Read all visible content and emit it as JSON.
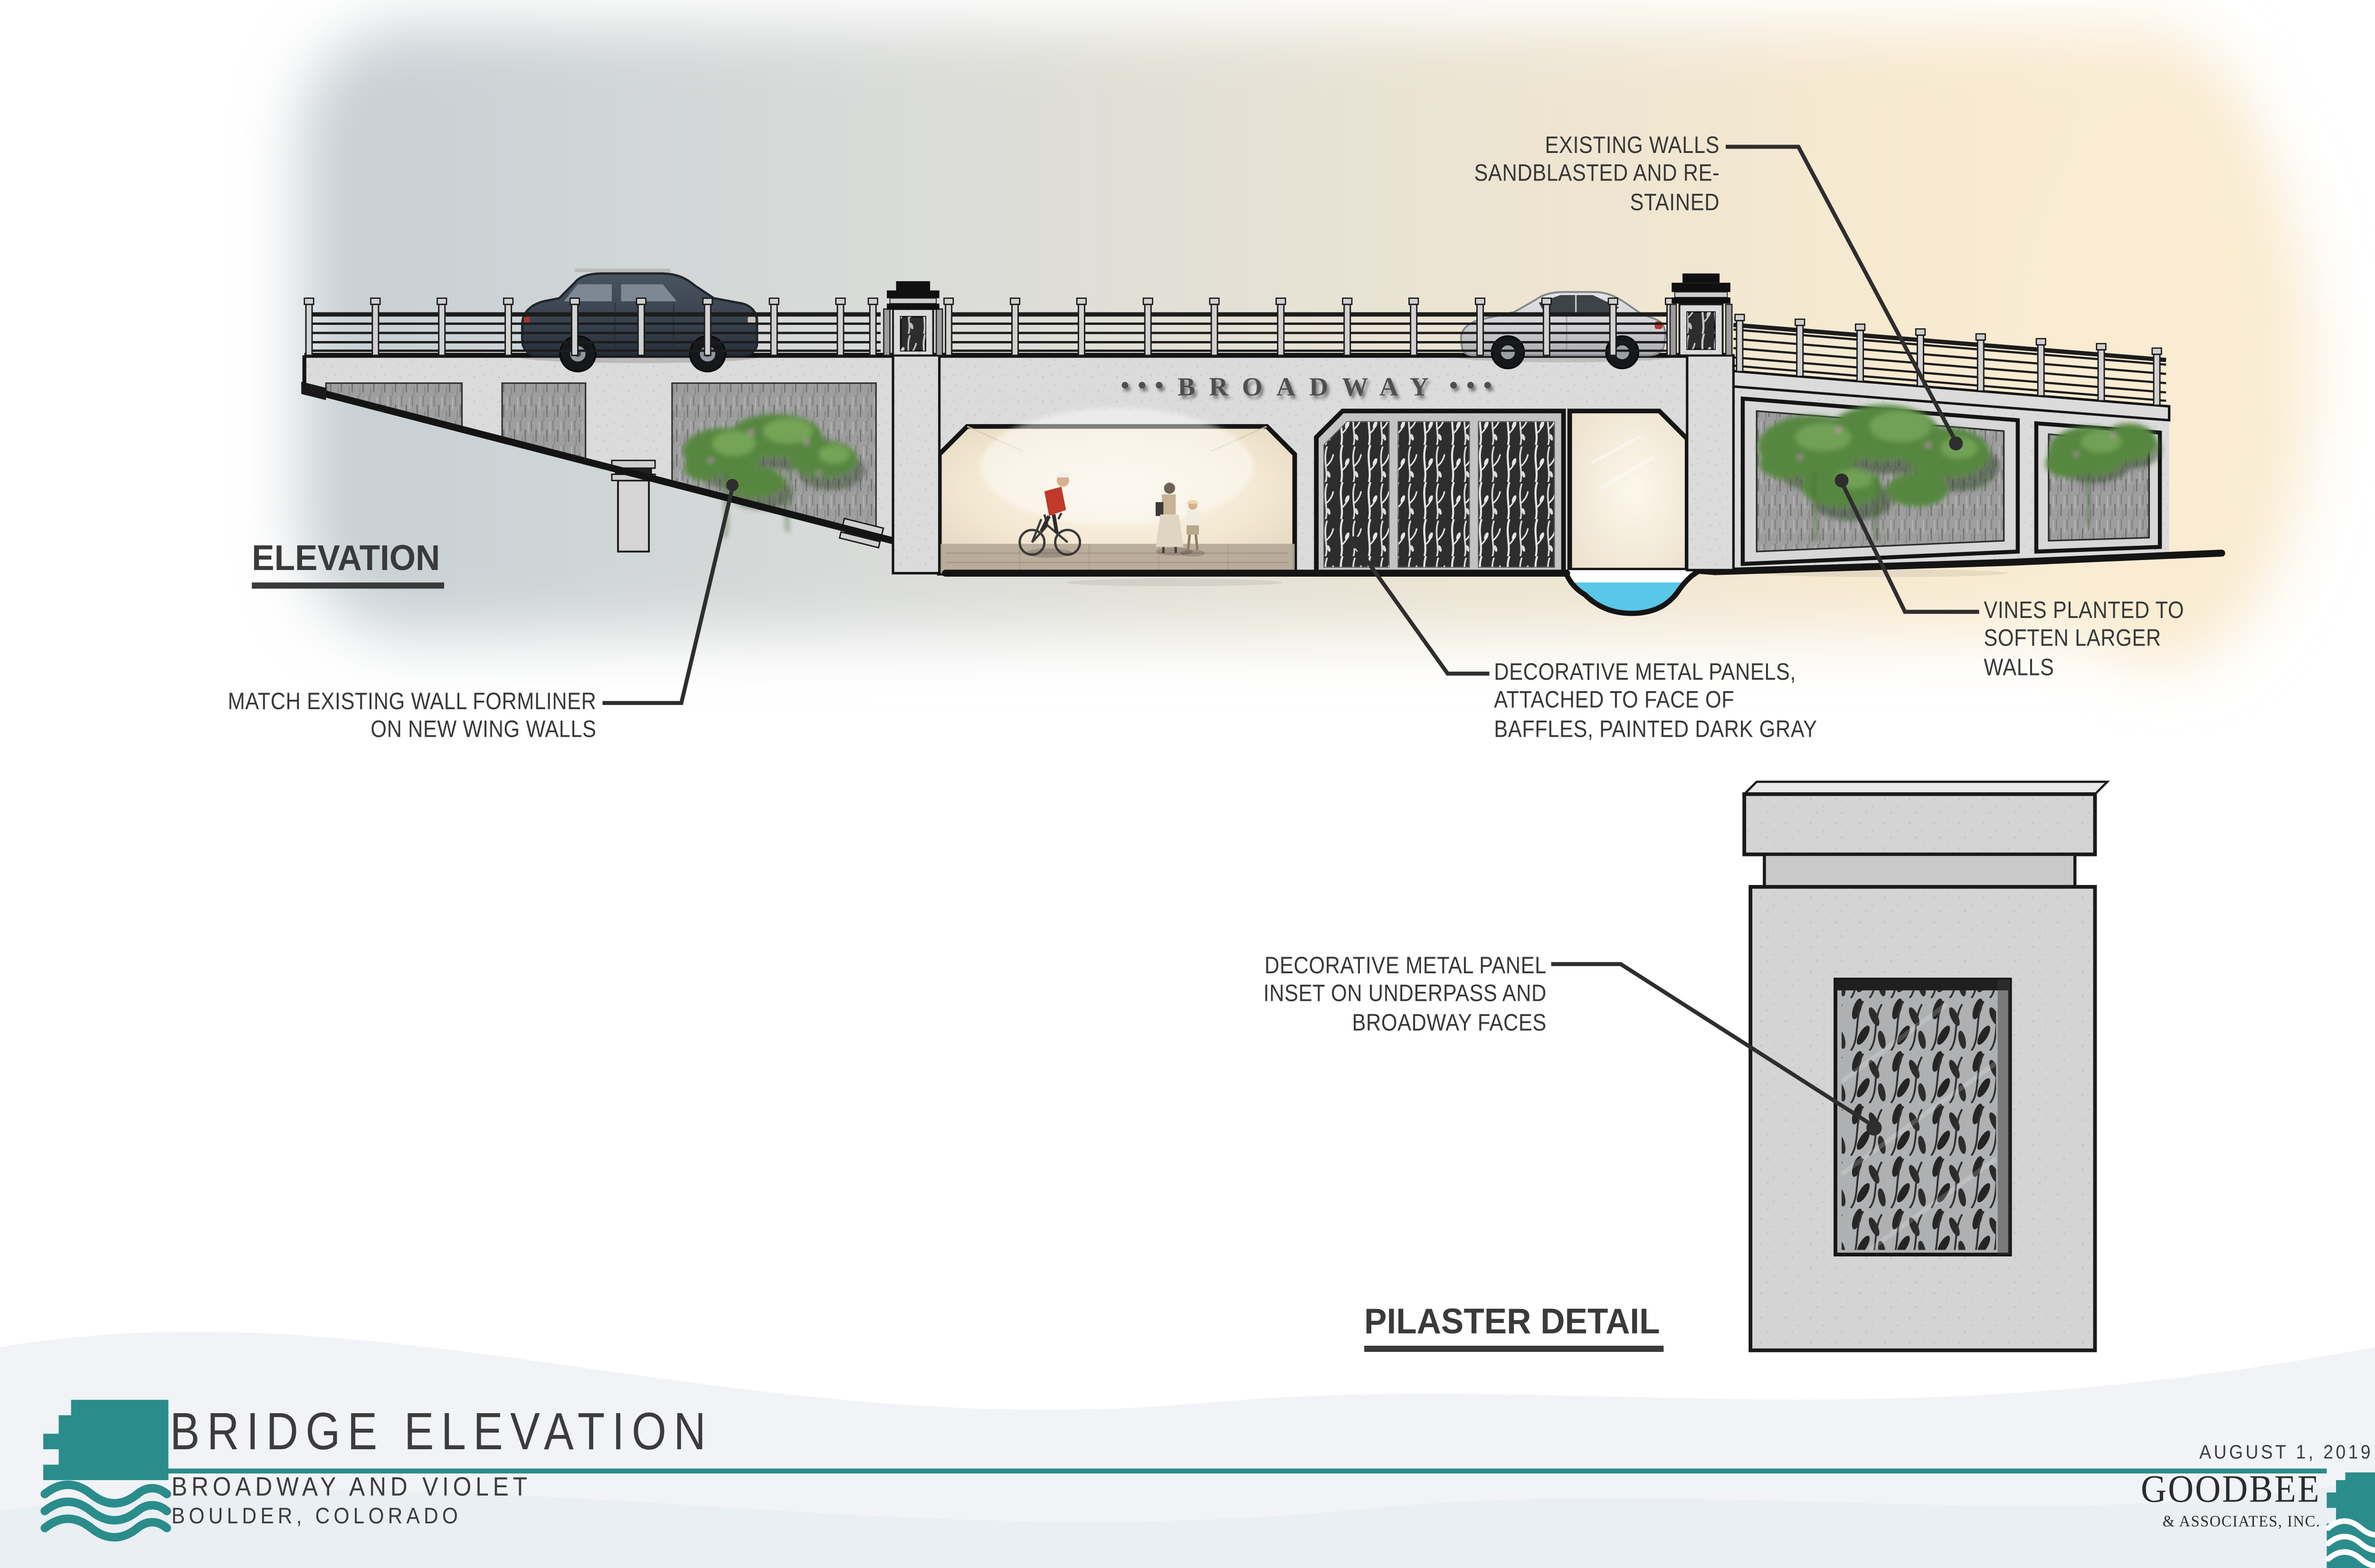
{
  "drawing": {
    "view_labels": {
      "elevation": "ELEVATION",
      "pilaster": "PILASTER DETAIL"
    },
    "bridge_sign": {
      "text": "BROADWAY",
      "side_dots": "●●●"
    },
    "annotations": {
      "existing_walls": "EXISTING WALLS\nSANDBLASTED AND RE-\nSTAINED",
      "match_formliner": "MATCH EXISTING WALL FORMLINER\nON NEW WING WALLS",
      "metal_panels": "DECORATIVE METAL PANELS,\nATTACHED TO FACE OF\nBAFFLES, PAINTED DARK GRAY",
      "vines": "VINES PLANTED TO\nSOFTEN LARGER\nWALLS",
      "panel_inset": "DECORATIVE METAL PANEL\nINSET ON UNDERPASS AND\nBROADWAY FACES"
    }
  },
  "title_block": {
    "sheet_title": "BRIDGE ELEVATION",
    "project": "BROADWAY AND VIOLET",
    "location": "BOULDER, COLORADO",
    "date": "AUGUST 1, 2019",
    "firm_name": "GOODBEE",
    "firm_suffix": "& ASSOCIATES, INC."
  },
  "colors": {
    "teal": "#2b8c8c",
    "ink": "#3a3a3a",
    "leader": "#2e2e2e",
    "concrete": "#d9dad9",
    "textured_wall": "#9e9e9e",
    "baffle_dark": "#2d2d2d",
    "water": "#58c7e8",
    "underpass_glow": "#f8efdd",
    "sky_cool": "#c7cfd4",
    "sky_warm": "#f8ead0",
    "vine_green": "#57873f"
  }
}
